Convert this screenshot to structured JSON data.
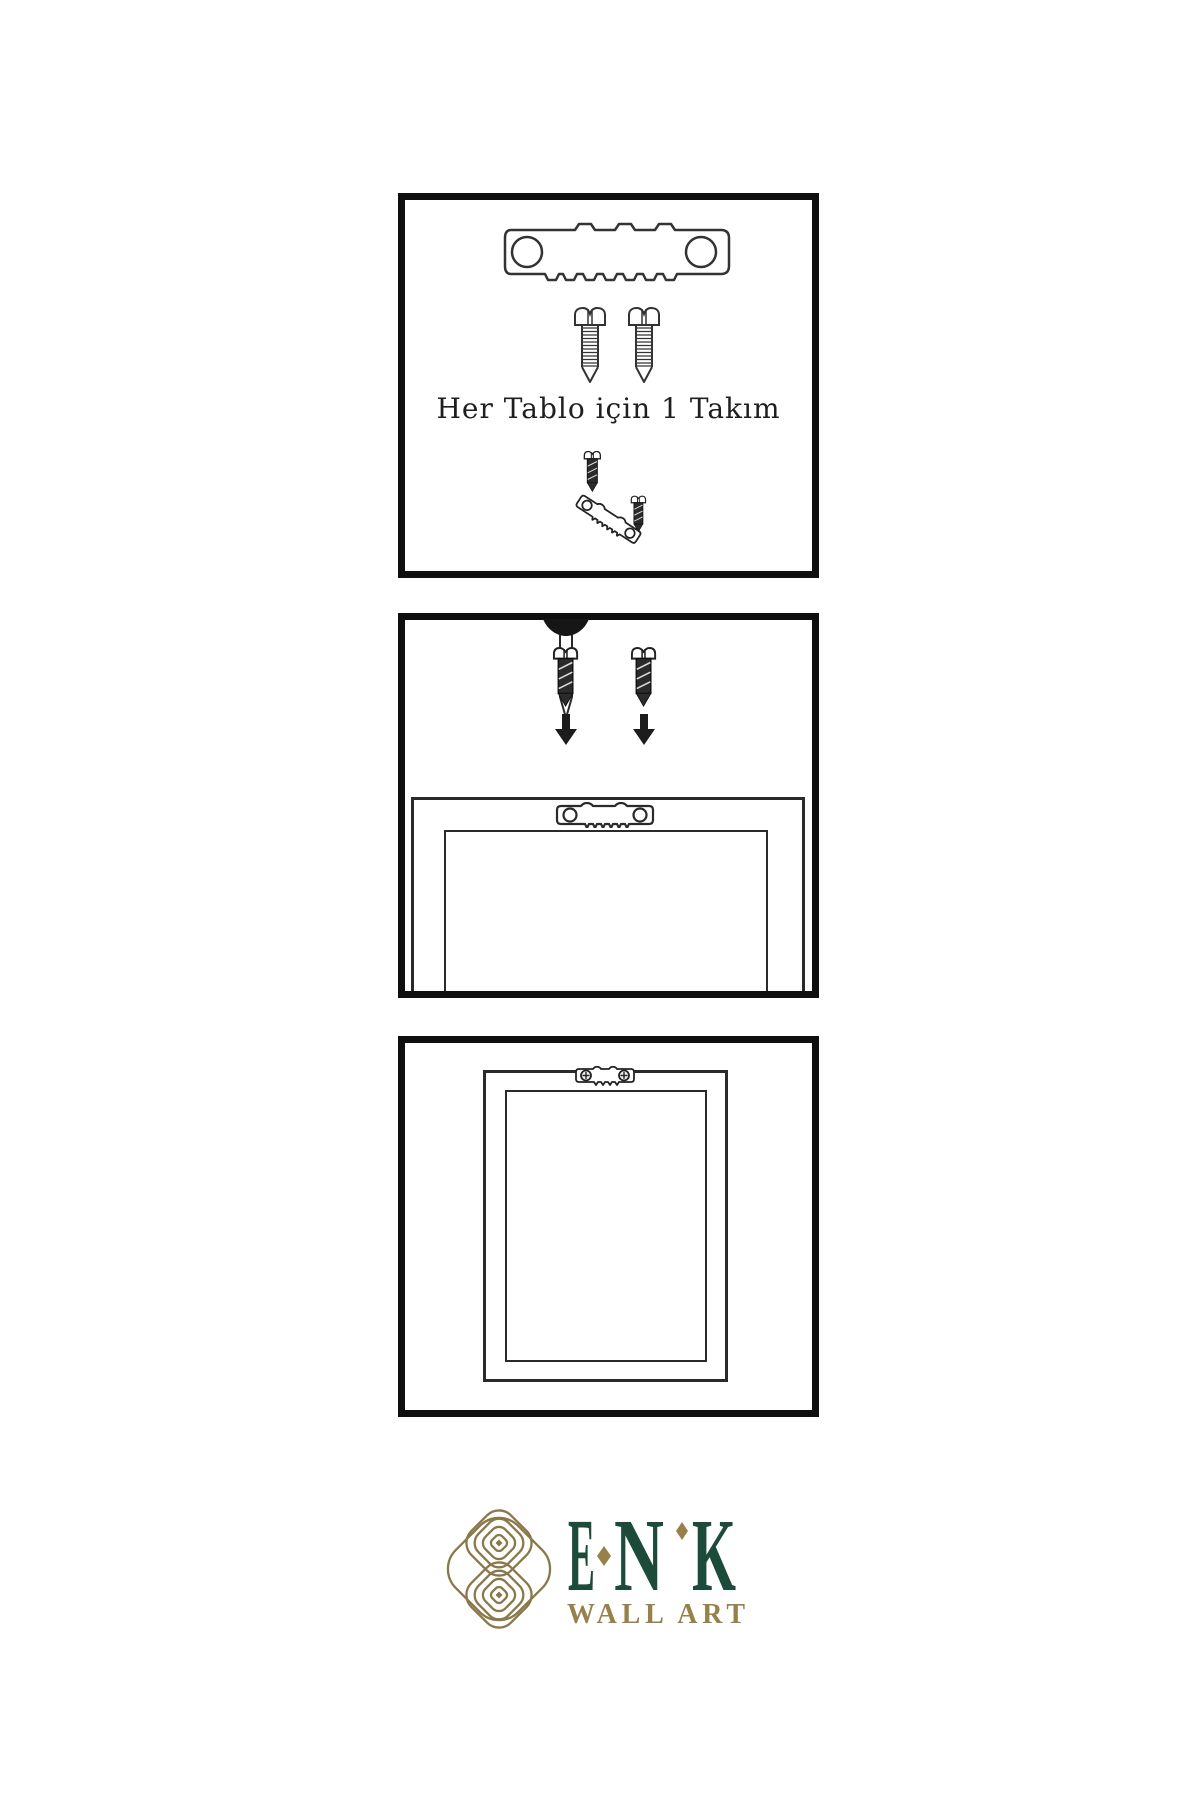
{
  "page": {
    "background_color": "#ffffff"
  },
  "steps": [
    {
      "caption": "Her Tablo için 1 Takım",
      "icons": [
        "sawtooth-hanger-icon",
        "screw-icon",
        "screw-icon",
        "screw-icon",
        "tilted-sawtooth-hanger-icon",
        "screw-icon"
      ]
    },
    {
      "icons": [
        "wall-nail-icon",
        "screw-icon",
        "down-arrow-icon",
        "screw-icon",
        "down-arrow-icon",
        "sawtooth-hanger-icon",
        "frame-back"
      ]
    },
    {
      "icons": [
        "mounted-sawtooth-hanger-icon",
        "hanging-frame"
      ]
    }
  ],
  "brand": {
    "name": "ENK",
    "letters": [
      "E",
      "N",
      "K"
    ],
    "subtitle": "WALL ART",
    "colors": {
      "green": "#1D4B3A",
      "gold": "#97814B",
      "knot_gold": "#8A784A",
      "line": "#2a2a2a",
      "panel_border": "#0f0f0f"
    }
  }
}
